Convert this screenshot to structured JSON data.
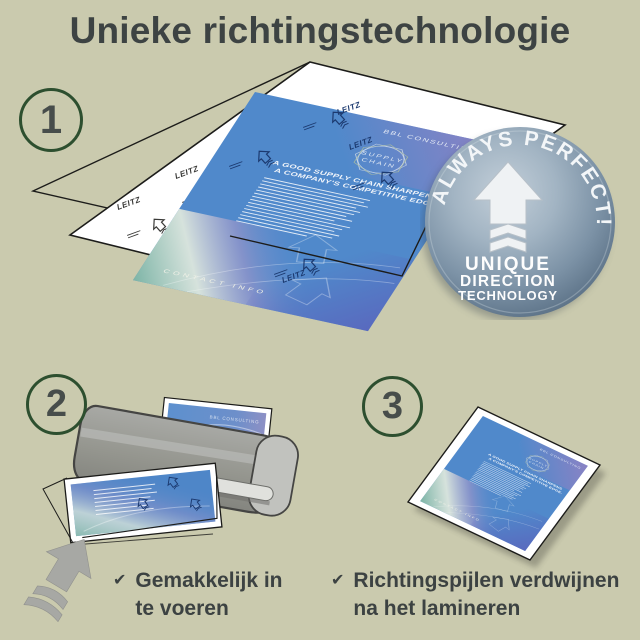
{
  "page": {
    "title": "Unieke richtingstechnologie",
    "background_color": "#cacaae",
    "text_color": "#3d4343"
  },
  "steps": [
    {
      "number": "1"
    },
    {
      "number": "2"
    },
    {
      "number": "3"
    }
  ],
  "badge": {
    "arc_text": "ALWAYS PERFECT!",
    "line1": "UNIQUE",
    "line2": "DIRECTION",
    "line3": "TECHNOLOGY",
    "icon": "direction-arrow-icon",
    "color_center": "#b8c5d1",
    "color_edge": "#5d7287"
  },
  "document": {
    "brand": "BBL CONSULTING",
    "emblem_line1": "SUPPLY",
    "emblem_line2": "CHAIN",
    "headline_line1": "A GOOD SUPPLY CHAIN SHARPENS",
    "headline_line2": "A COMPANY'S COMPETITIVE EDGE.",
    "footer": "CONTACT INFO",
    "color": "#5089cb"
  },
  "pouch": {
    "brand": "LEITZ",
    "print_color": "#1c3a70"
  },
  "captions": [
    {
      "check": "✔",
      "line1": "Gemakkelijk in",
      "line2": "te voeren"
    },
    {
      "check": "✔",
      "line1": "Richtingspijlen verdwijnen",
      "line2": "na het lamineren"
    }
  ]
}
